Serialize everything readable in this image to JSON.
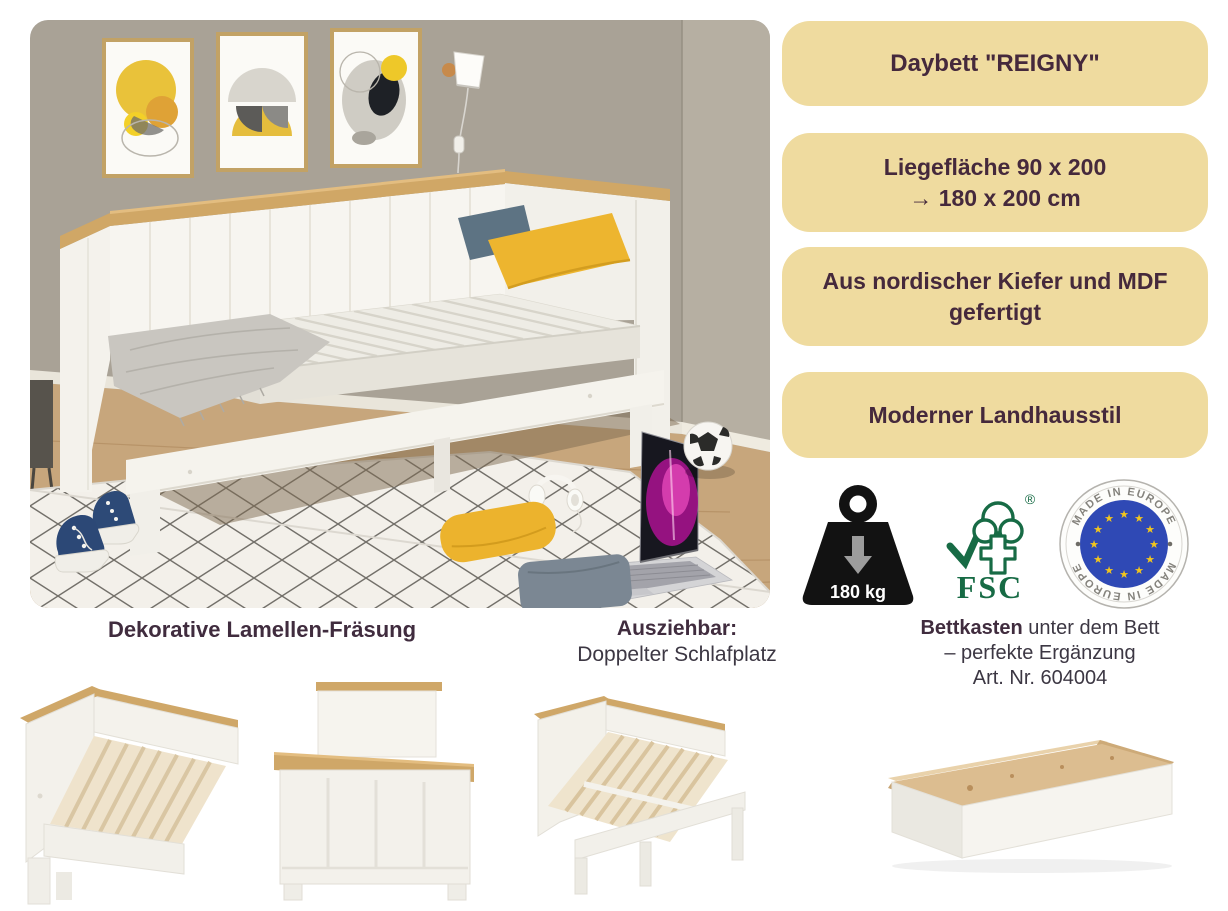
{
  "badges": [
    {
      "lines": [
        "Daybett \"REIGNY\""
      ]
    },
    {
      "lines": [
        "Liegefläche 90 x 200",
        "→ 180 x 200 cm"
      ]
    },
    {
      "lines": [
        "Aus nordischer Kiefer und MDF",
        "gefertigt"
      ]
    },
    {
      "lines": [
        "Moderner Landhausstil"
      ]
    }
  ],
  "certifications": {
    "weight_capacity": "180 kg",
    "fsc_label": "FSC",
    "fsc_registered": "®",
    "eu_text_top": "MADE IN EUROPE",
    "eu_text_bottom": "MADE IN EUROPE"
  },
  "features": [
    {
      "title": "Dekorative Lamellen-Fräsung"
    },
    {
      "title": "Ausziehbar:",
      "subtitle": "Doppelter Schlafplatz"
    },
    {
      "title_bold": "Bettkasten",
      "title_rest": " unter dem Bett",
      "line2": "– perfekte Ergänzung",
      "line3": "Art. Nr. 604004"
    }
  ],
  "colors": {
    "badge_background": "#EFDB9F",
    "badge_text": "#45293C",
    "accent_yellow_pillow": "#EDB52F",
    "oak_trim": "#D0A766",
    "fsc_green": "#176B45",
    "eu_blue": "#2F49B5",
    "eu_star_gold": "#F2C51D",
    "wall_taupe": "#A9A296"
  }
}
